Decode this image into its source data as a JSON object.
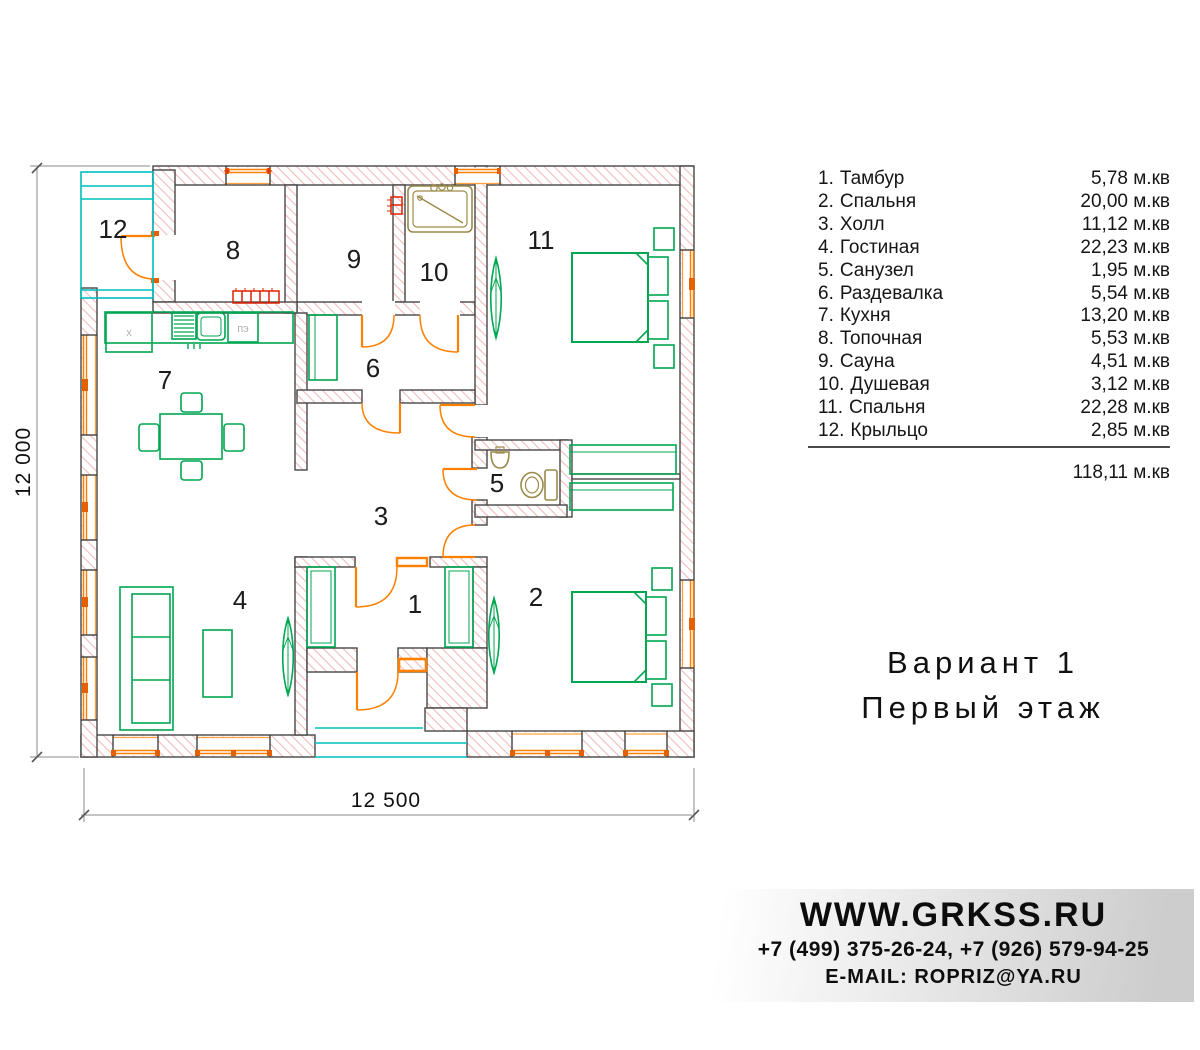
{
  "plan": {
    "rooms": [
      {
        "n": "1"
      },
      {
        "n": "2"
      },
      {
        "n": "3"
      },
      {
        "n": "4"
      },
      {
        "n": "5"
      },
      {
        "n": "6"
      },
      {
        "n": "7"
      },
      {
        "n": "8"
      },
      {
        "n": "9"
      },
      {
        "n": "10"
      },
      {
        "n": "11"
      },
      {
        "n": "12"
      }
    ],
    "kitchen": {
      "fridge_label": "х",
      "stove_label": "пэ"
    },
    "dimensions": {
      "height_label": "12 000",
      "width_label": "12 500"
    },
    "colors": {
      "furniture_green": "#00a651",
      "window_door_orange": "#ff8000",
      "porch_cyan": "#00bfbf",
      "wall_hatch_pink": "#f3bcbc",
      "wall_outline_gray": "#474747",
      "sanitary_tan": "#9c8a4a",
      "radiator_red": "#dd2200"
    }
  },
  "legend": {
    "items": [
      {
        "num": "1.",
        "name": "Тамбур",
        "area": "5,78 м.кв"
      },
      {
        "num": "2.",
        "name": "Спальня",
        "area": "20,00 м.кв"
      },
      {
        "num": "3.",
        "name": "Холл",
        "area": "11,12 м.кв"
      },
      {
        "num": "4.",
        "name": "Гостиная",
        "area": "22,23 м.кв"
      },
      {
        "num": "5.",
        "name": "Санузел",
        "area": "1,95 м.кв"
      },
      {
        "num": "6.",
        "name": "Раздевалка",
        "area": "5,54 м.кв"
      },
      {
        "num": "7.",
        "name": "Кухня",
        "area": "13,20 м.кв"
      },
      {
        "num": "8.",
        "name": "Топочная",
        "area": "5,53 м.кв"
      },
      {
        "num": "9.",
        "name": "Сауна",
        "area": "4,51 м.кв"
      },
      {
        "num": "10.",
        "name": "Душевая",
        "area": "3,12 м.кв"
      },
      {
        "num": "11.",
        "name": "Спальня",
        "area": "22,28 м.кв"
      },
      {
        "num": "12.",
        "name": "Крыльцо",
        "area": "2,85 м.кв"
      }
    ],
    "total": "118,11 м.кв"
  },
  "title": {
    "line1": "Вариант 1",
    "line2": "Первый этаж"
  },
  "footer": {
    "website": "WWW.GRKSS.RU",
    "phones": "+7 (499) 375-26-24, +7 (926) 579-94-25",
    "email": "E-MAIL: ROPRIZ@YA.RU"
  }
}
